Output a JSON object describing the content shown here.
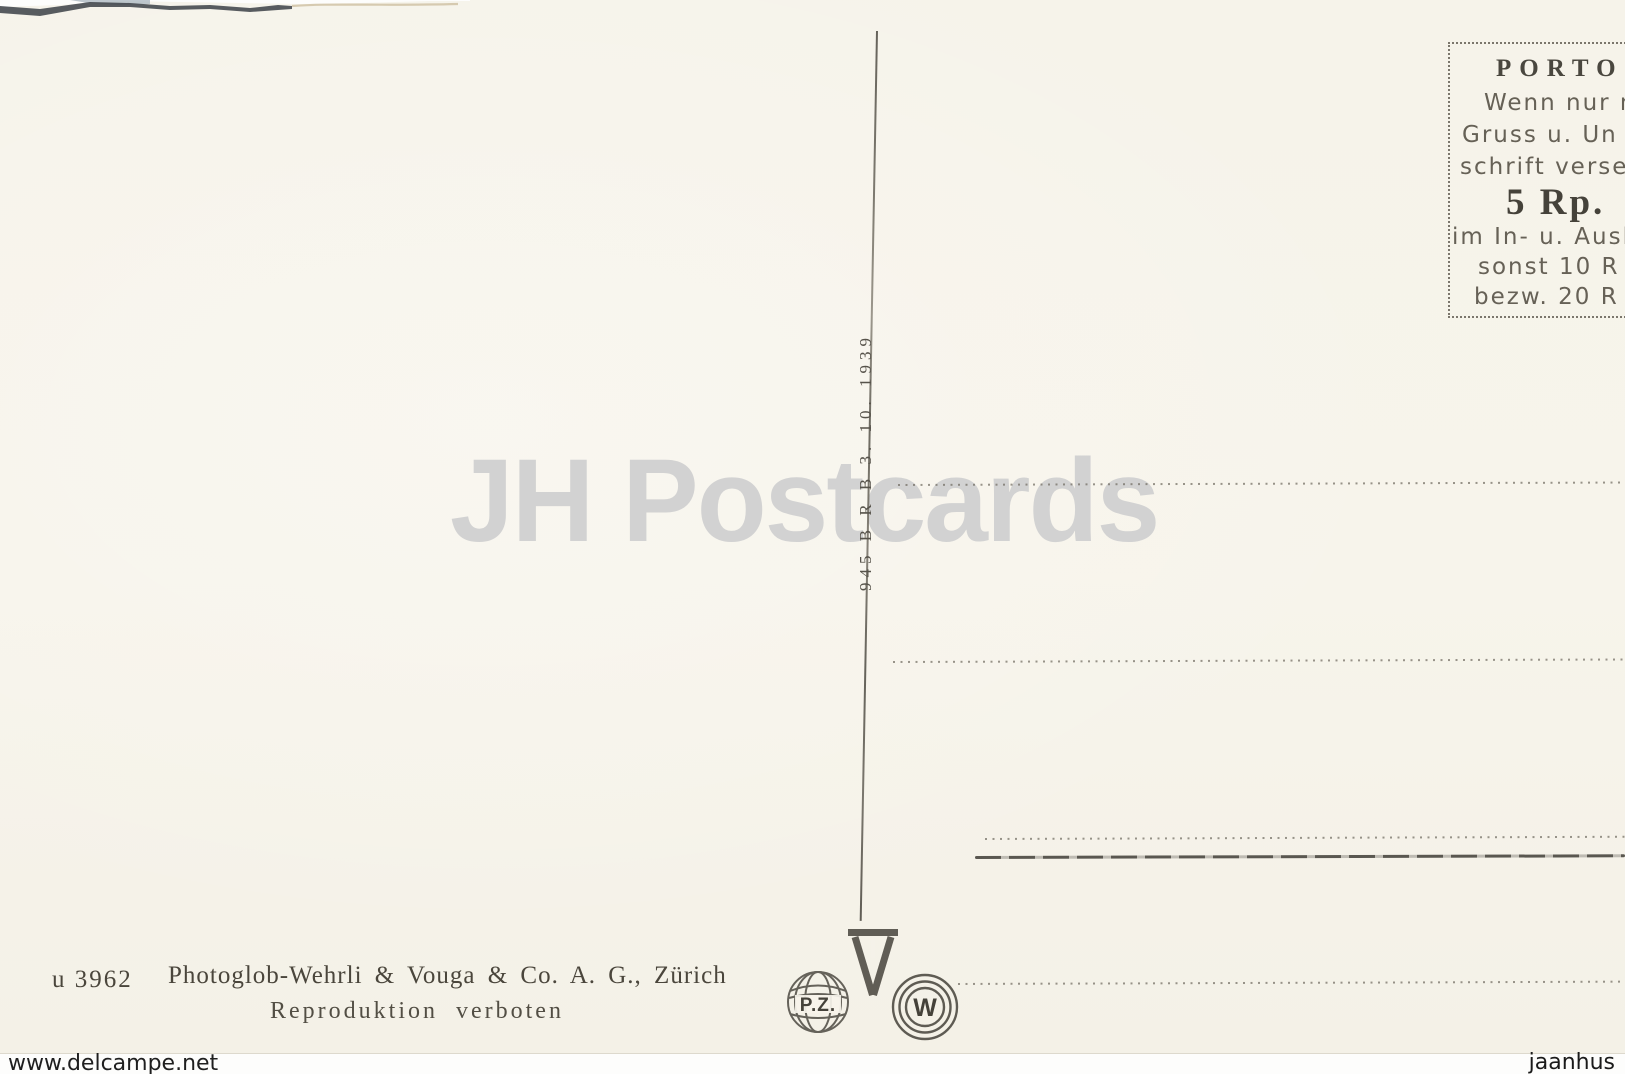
{
  "site": {
    "watermark_left": "www.delcampe.net",
    "watermark_right": "jaanhus"
  },
  "postcard": {
    "seller_watermark": "JH Postcards",
    "print_code_vertical": "945 B R B 3. 10. 1939",
    "stamp_box": {
      "title": "PORTO",
      "line_wenn": "Wenn nur m",
      "line_gruss": "Gruss u. Un",
      "line_schrift": "schrift verse",
      "price": "5 Rp.",
      "line_inland": "im In- u. Ausl",
      "line_sonst": "sonst 10 R",
      "line_bezw": "bezw. 20 R"
    },
    "imprint": {
      "number": "u 3962",
      "publisher": "Photoglob-Wehrli & Vouga & Co. A. G., Zürich",
      "notice": "Reproduktion verboten"
    },
    "logos": {
      "pz_label": "P.Z.",
      "w_label": "W"
    },
    "colors": {
      "paper": "#f6f3ea",
      "ink": "#4e4a40",
      "seller_watermark_gray": "#d2d2d2",
      "site_strip": "#fdfdfc"
    }
  }
}
